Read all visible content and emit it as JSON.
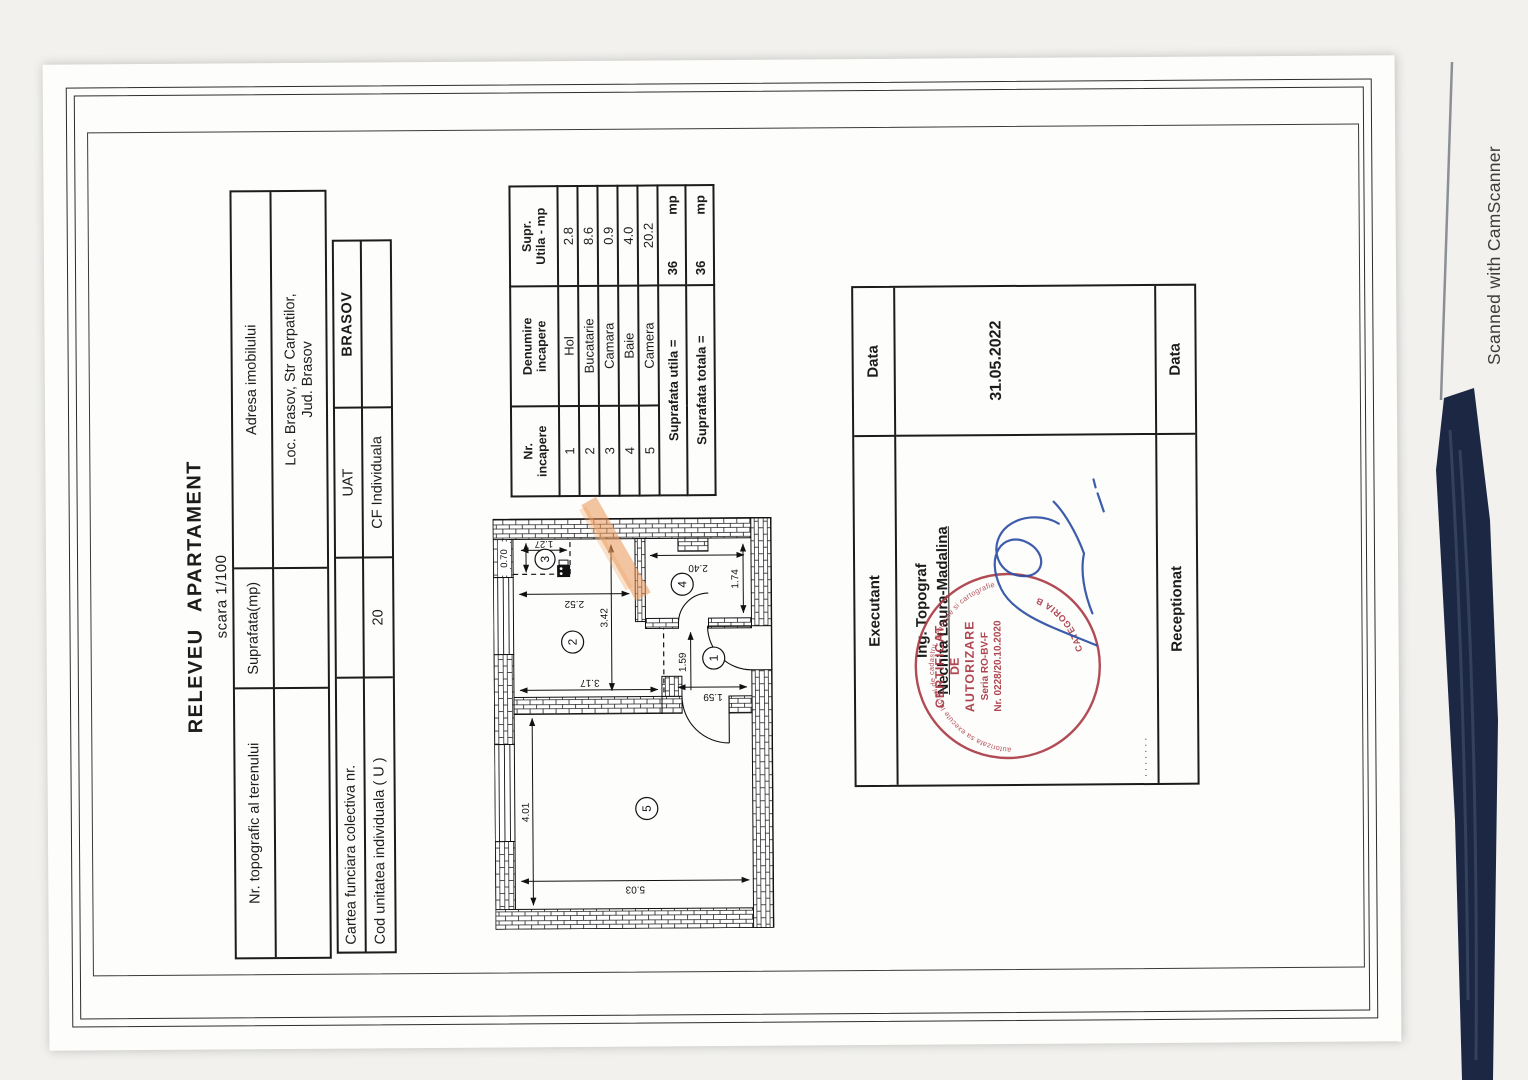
{
  "page": {
    "camscanner": "Scanned with CamScanner"
  },
  "title": {
    "main": "RELEVEU  APARTAMENT",
    "scale": "scara 1/100"
  },
  "table_imobil": {
    "col1": "Nr. topografic al terenului",
    "col2": "Suprafata(mp)",
    "col3": "Adresa imobilului",
    "address_line1": "Loc. Brasov, Str Carpatilor,",
    "address_line2": "Jud. Brasov"
  },
  "table_cf": {
    "row1_label": "Cartea funciara colectiva nr.",
    "row1_value": "",
    "uat_label": "UAT",
    "uat_value": "BRASOV",
    "row2_label": "Cod unitatea individuala ( U )",
    "row2_value": "20",
    "cf_label": "CF Individuala",
    "cf_value": ""
  },
  "room_table": {
    "header": {
      "col1a": "Nr.",
      "col1b": "incapere",
      "col2a": "Denumire",
      "col2b": "incapere",
      "col3a": "Supr.",
      "col3b": "Utila - mp"
    },
    "rows": [
      {
        "nr": "1",
        "name": "Hol",
        "supr": "2.8"
      },
      {
        "nr": "2",
        "name": "Bucatarie",
        "supr": "8.6"
      },
      {
        "nr": "3",
        "name": "Camara",
        "supr": "0.9"
      },
      {
        "nr": "4",
        "name": "Baie",
        "supr": "4.0"
      },
      {
        "nr": "5",
        "name": "Camera",
        "supr": "20.2"
      }
    ],
    "total_utila_label": "Suprafata utila =",
    "total_utila_value": "36",
    "total_utila_unit": "mp",
    "total_totala_label": "Suprafata totala =",
    "total_totala_value": "36",
    "total_totala_unit": "mp"
  },
  "plan": {
    "rooms": [
      "1",
      "2",
      "3",
      "4",
      "5"
    ],
    "dims": {
      "cam_w": "4.01",
      "cam_h": "5.03",
      "buc_w": "3.42",
      "buc_h_dr": "2.52",
      "buc_h_st": "3.17",
      "camara_h": "1.27",
      "camara_w": "0.70",
      "baie_h": "2.40",
      "baie_w": "1.74",
      "hol_w": "1.59",
      "hol_h": "1.59"
    }
  },
  "executant": {
    "header_left": "Executant",
    "header_right": "Data",
    "role": "Ing. Topograf",
    "name": "Nechita Laura-Madalina",
    "date": "31.05.2022",
    "row3_left": "Receptionat",
    "row3_right": "Data"
  },
  "stamp": {
    "line1": "CERTIFICAT",
    "line2": "DE",
    "line3": "AUTORIZARE",
    "line4": "Seria RO-BV-F",
    "line5": "Nr. 0228/20.10.2020",
    "ring_top": "autorizata sa execute lucrari de cadastru, geodezie si cartografie",
    "ring_bottom": "CATEGORIA B"
  },
  "colors": {
    "ink": "#1c1c1c",
    "stamp_red": "#a83743",
    "signature_blue": "#2d4fa5",
    "highlight_orange": "#e8965a",
    "denim": "#1c2743"
  }
}
